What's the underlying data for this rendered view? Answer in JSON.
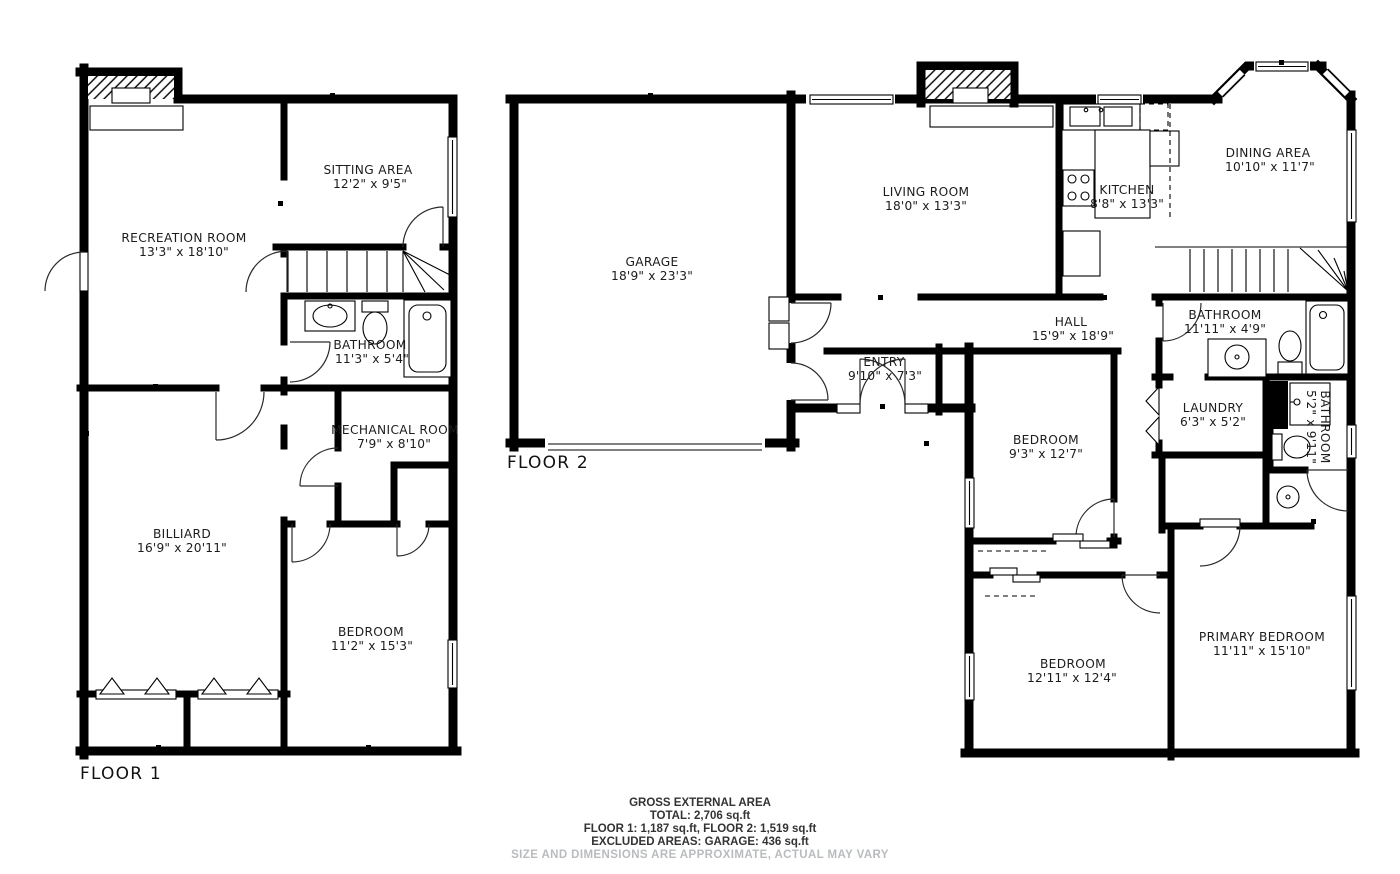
{
  "colors": {
    "wall": "#000000",
    "label": "#1c1c1c",
    "muted": "#b9bcbe",
    "background": "#ffffff"
  },
  "floor1": {
    "label": "FLOOR 1",
    "rooms": [
      {
        "name": "SITTING AREA",
        "dims": "12'2\" x 9'5\""
      },
      {
        "name": "RECREATION ROOM",
        "dims": "13'3\" x 18'10\""
      },
      {
        "name": "BATHROOM",
        "dims": "11'3\" x 5'4\""
      },
      {
        "name": "MECHANICAL ROOM",
        "dims": "7'9\" x 8'10\""
      },
      {
        "name": "BILLIARD",
        "dims": "16'9\" x 20'11\""
      },
      {
        "name": "BEDROOM",
        "dims": "11'2\" x 15'3\""
      }
    ]
  },
  "floor2": {
    "label": "FLOOR 2",
    "rooms": [
      {
        "name": "GARAGE",
        "dims": "18'9\" x 23'3\""
      },
      {
        "name": "LIVING ROOM",
        "dims": "18'0\" x 13'3\""
      },
      {
        "name": "KITCHEN",
        "dims": "8'8\" x 13'3\""
      },
      {
        "name": "DINING AREA",
        "dims": "10'10\" x 11'7\""
      },
      {
        "name": "HALL",
        "dims": "15'9\" x 18'9\""
      },
      {
        "name": "ENTRY",
        "dims": "9'10\" x 7'3\""
      },
      {
        "name": "BATHROOM",
        "dims": "11'11\" x 4'9\""
      },
      {
        "name": "LAUNDRY",
        "dims": "6'3\" x 5'2\""
      },
      {
        "name": "BATHROOM",
        "dims": "5'2\" x 9'11\""
      },
      {
        "name": "BEDROOM",
        "dims": "9'3\" x 12'7\""
      },
      {
        "name": "BEDROOM",
        "dims": "12'11\" x 12'4\""
      },
      {
        "name": "PRIMARY BEDROOM",
        "dims": "11'11\" x 15'10\""
      }
    ]
  },
  "footer": {
    "line1": "GROSS EXTERNAL AREA",
    "line2": "TOTAL: 2,706 sq.ft",
    "line3": "FLOOR 1: 1,187 sq.ft, FLOOR 2: 1,519 sq.ft",
    "line4": "EXCLUDED AREAS: GARAGE: 436 sq.ft",
    "disclaimer": "SIZE AND DIMENSIONS ARE APPROXIMATE, ACTUAL MAY VARY"
  }
}
